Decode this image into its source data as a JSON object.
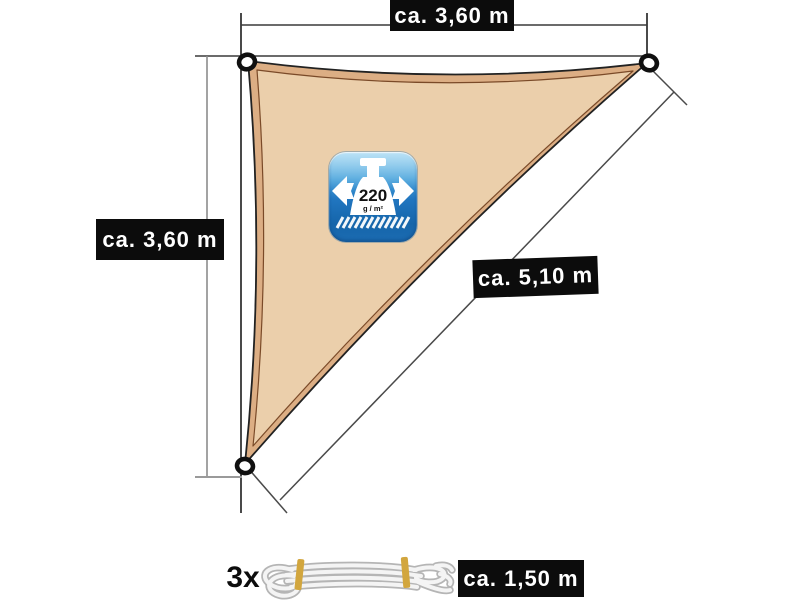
{
  "diagram": {
    "title_hint": "triangular sun shade sail dimension diagram",
    "labels": {
      "top_width": "ca. 3,60 m",
      "left_height": "ca. 3,60 m",
      "diagonal": "ca. 5,10 m",
      "rope_length": "ca. 1,50 m"
    },
    "badge": {
      "weight_value": "220",
      "weight_unit": "g / m²"
    },
    "rope": {
      "quantity": "3x"
    },
    "icons": {
      "badge_left_arrow": "arrow-left",
      "badge_right_arrow": "arrow-right",
      "badge_weight": "weight-block",
      "badge_ground": "hatched-ground",
      "corner_rings": "grommet-ring",
      "rope": "coiled-rope"
    },
    "colors": {
      "sail_fill": "#ebcfab",
      "sail_border_band": "#dcae84",
      "sail_outline": "#222222",
      "sail_inner_line": "#7a4a28",
      "badge_blue_top": "#93d2f1",
      "badge_blue_bottom": "#1c6cb2",
      "label_background": "#0c0c0c",
      "label_text": "#ffffff",
      "rope_tie_yellow": "#d2a63e",
      "dimension_line": "#3a3a3a"
    }
  }
}
